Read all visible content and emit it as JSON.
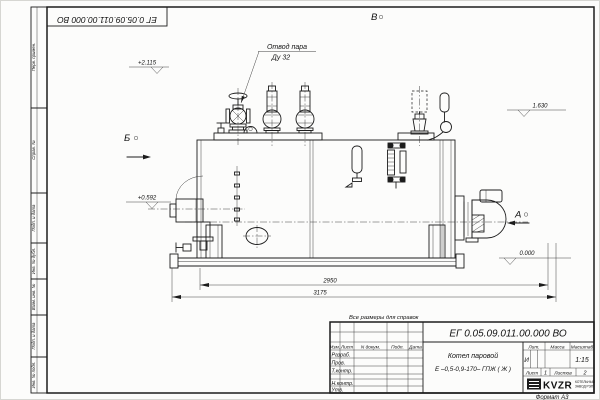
{
  "sheet": {
    "note": "Все размеры для справок",
    "format": "Формат А3",
    "designation_top": "ЕГ 0.05.09.011.00.000  ВО",
    "margin_labels": {
      "perv_primen": "Перв. примен.",
      "sprav_no": "Справ. №",
      "podp_data_1": "Подп. и дата",
      "inv_dubl": "Инв. № дубл.",
      "vzam_inv": "Взам. инв. №",
      "podp_data_2": "Подп. и дата",
      "inv_podl": "Инв. № подл."
    }
  },
  "drawing": {
    "callout_line1": "Отвод пара",
    "callout_line2": "Ду 32",
    "view_b": "Б",
    "view_v": "В",
    "view_a": "А",
    "elev_top": "+2.115",
    "elev_right": "1.630",
    "elev_hatch": "+0.592",
    "elev_floor": "0.000",
    "dim_inner": "2950",
    "dim_overall": "3175"
  },
  "title_block": {
    "designation": "ЕГ 0.05.09.011.00.000  ВО",
    "product_line1": "Котел паровой",
    "product_line2": "Е –0,5-0,9-170– ГПЖ ( Ж )",
    "col_izm": "Изм.",
    "col_list": "Лист",
    "col_ndoc": "N докум.",
    "col_podp": "Подп.",
    "col_data": "Дата",
    "row_razrab": "Разраб.",
    "row_prov": "Пров.",
    "row_tkontr": "Т.контр.",
    "row_nkontr": "Н.контр.",
    "row_utv": "Утв.",
    "lit_label": "Лит.",
    "lit_value": "И",
    "mass_label": "Масса",
    "scale_label": "Масштаб",
    "scale_value": "1:15",
    "sheet_label": "Лист",
    "sheet_value": "1",
    "sheets_label": "Листов",
    "sheets_value": "2",
    "company": "KVZR",
    "company_line1": "КОТЕЛЬНЫЙ",
    "company_line2": "ЗАВОД РЭП"
  }
}
